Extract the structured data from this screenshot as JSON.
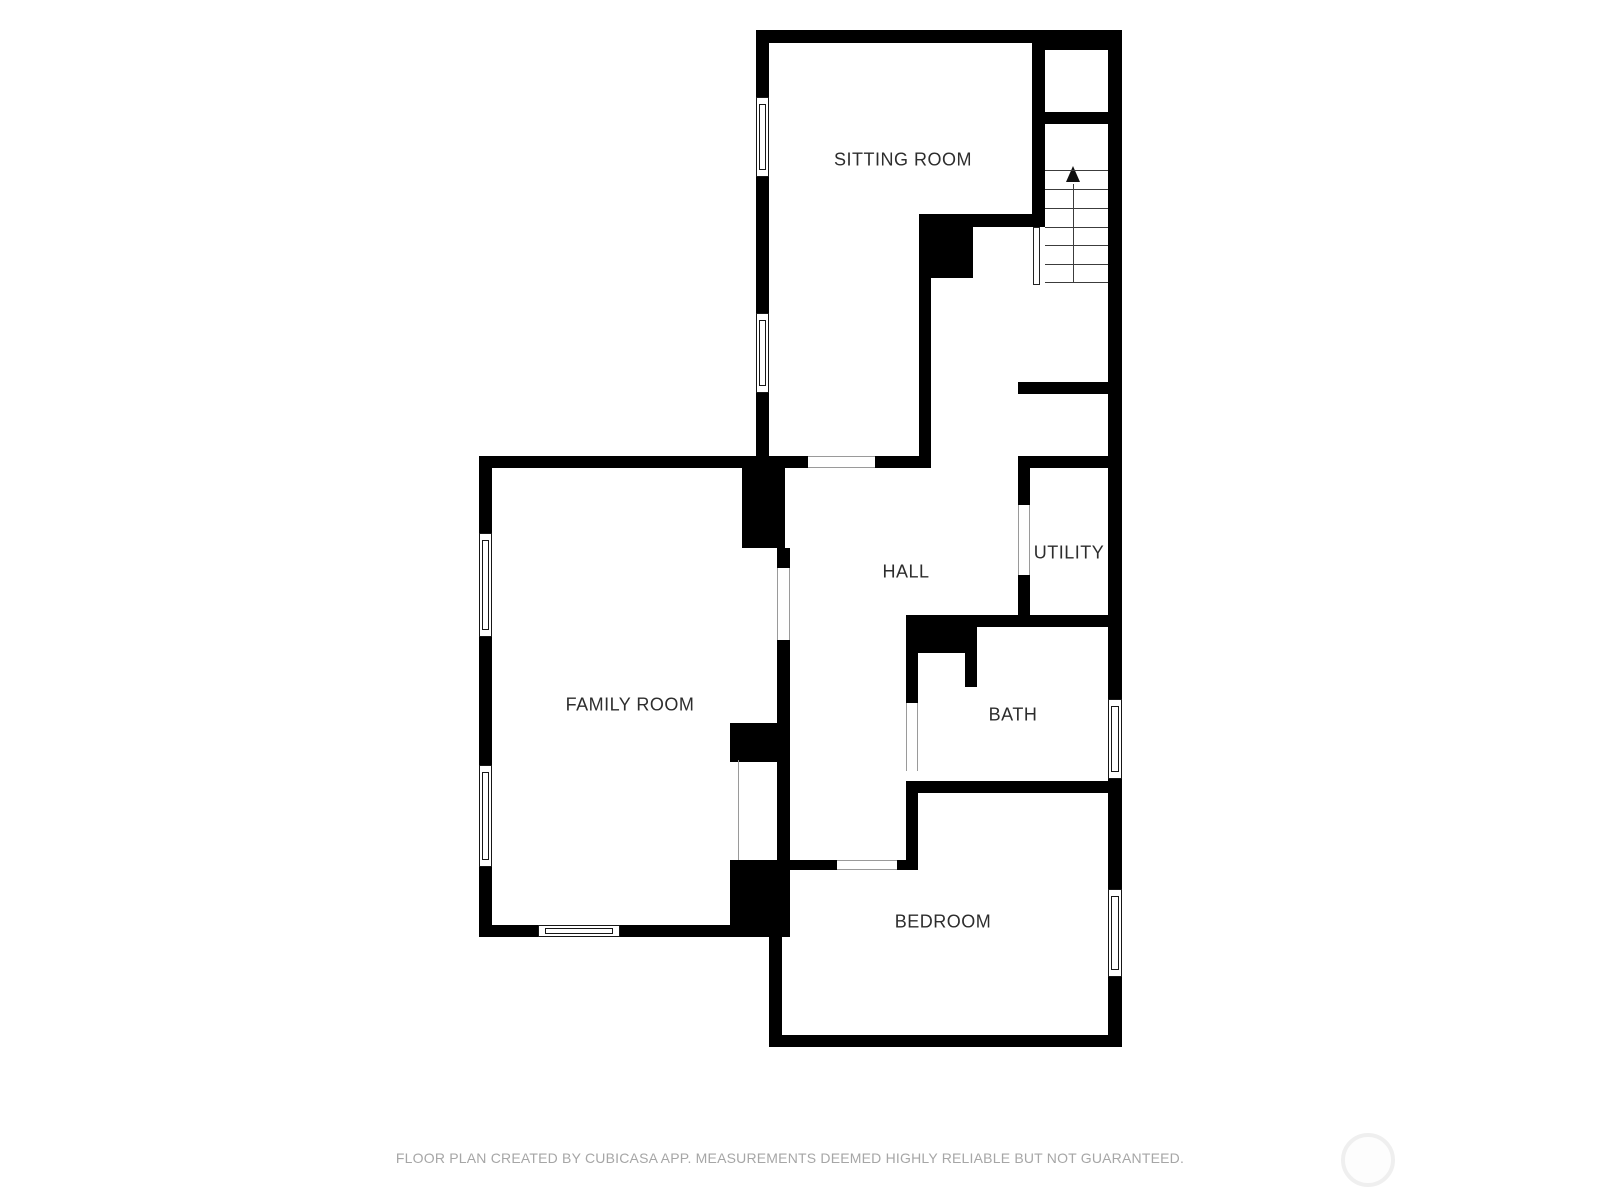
{
  "floor_plan": {
    "rooms": [
      {
        "id": "sitting-room",
        "label": "SITTING ROOM"
      },
      {
        "id": "family-room",
        "label": "FAMILY ROOM"
      },
      {
        "id": "hall",
        "label": "HALL"
      },
      {
        "id": "utility",
        "label": "UTILITY"
      },
      {
        "id": "bath",
        "label": "BATH"
      },
      {
        "id": "bedroom",
        "label": "BEDROOM"
      }
    ],
    "stairs": {
      "icon": "arrow-up-icon",
      "direction": "up",
      "tread_count": 7
    },
    "features": {
      "window_count": 7,
      "door_opening_count": 5
    },
    "colors": {
      "wall": "#000000",
      "room_label": "#2d2d2d",
      "opening_jamb": "#9a9a9a",
      "footer_text": "#a6a6a6",
      "watermark_ring": "#efefef",
      "background": "#ffffff"
    }
  },
  "footer": {
    "disclaimer": "FLOOR PLAN CREATED BY CUBICASA APP. MEASUREMENTS DEEMED HIGHLY RELIABLE BUT NOT GUARANTEED."
  },
  "branding": {
    "watermark": "cubicasa-logo-circle"
  }
}
